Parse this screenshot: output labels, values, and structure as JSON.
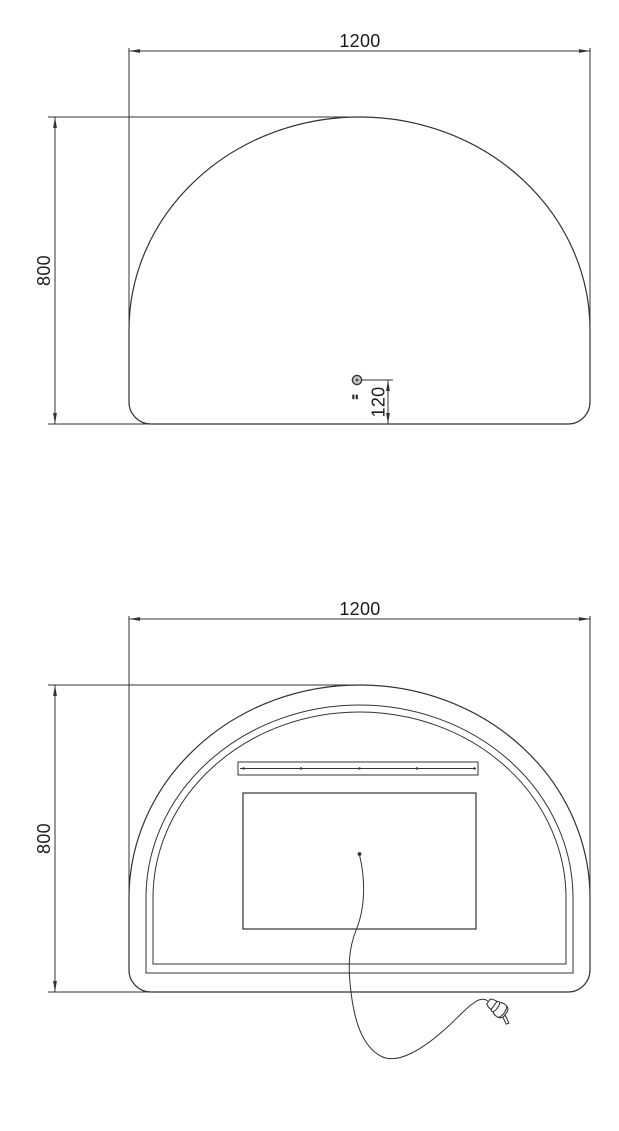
{
  "drawing": {
    "colors": {
      "line": "#333333",
      "text": "#1a1a1a",
      "background": "#ffffff"
    },
    "front_view": {
      "width_label": "1200",
      "height_label": "800",
      "sensor_offset_label": "120"
    },
    "back_view": {
      "width_label": "1200",
      "height_label": "800"
    },
    "icons": {
      "sensor": "sensor-dot-icon",
      "switch": "touch-switch-icon",
      "plug": "power-plug-icon"
    }
  }
}
